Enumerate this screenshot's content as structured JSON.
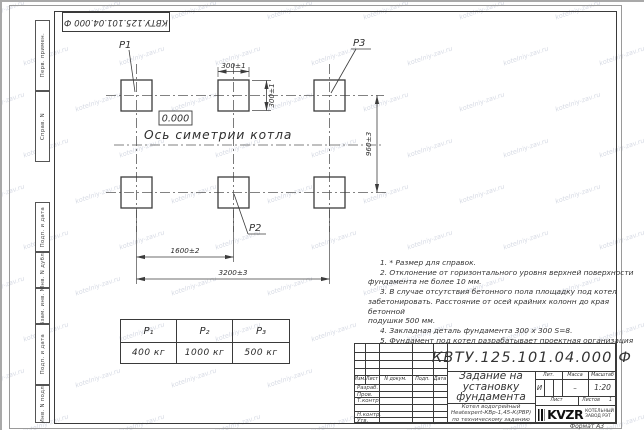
{
  "watermark": {
    "text": "kotelniy-zav.ru"
  },
  "stamp_top": {
    "designation": "КВТУ.125.101.04.000 Ф"
  },
  "frame": {
    "left_top_labels": [
      "Перв. примен.",
      "Справ. N"
    ],
    "left_bottom_labels": [
      "Подп. и дата",
      "Инв. N дубл.",
      "Взам. инв. N",
      "Подп. и дата",
      "Инв. N подл."
    ],
    "format_label": "Формат А3"
  },
  "drawing": {
    "pad_labels": {
      "p1": "P1",
      "p2": "P2",
      "p3": "P3"
    },
    "elevation": "0.000",
    "axis_label": "Ось симетрии котла",
    "dims": {
      "pad_width": "300±1",
      "pad_height": "300±1",
      "row_spacing": "960±3",
      "col_spacing": "1600±2",
      "total_width": "3200±3"
    }
  },
  "notes": {
    "lines": [
      "1. * Размер для справок.",
      "2. Отклонение от горизонтального уровня верхней поверхности",
      "фундамента не более 10 мм.",
      "3. В случае отсутствия бетонного пола площадку под котел",
      "забетонировать. Расстояние от осей крайних колонн до края бетонной",
      "подушки 500 мм.",
      "4. Закладная деталь фундамента 300 х 300 S=8.",
      "5. Фундамент под котел разрабатывает проектная организация",
      "по нагрузкам на фундамент."
    ]
  },
  "load_table": {
    "headers": [
      "P₁",
      "P₂",
      "P₃"
    ],
    "values": [
      "400 кг",
      "1000 кг",
      "500 кг"
    ]
  },
  "title_block": {
    "designation": "КВТУ.125.101.04.000  Ф",
    "doc_title_lines": [
      "Задание на",
      "установку",
      "фундамента"
    ],
    "subtitle_lines": [
      "Котел водогрейный",
      "Heatexpert-КВр-1,45-К(РВР)",
      "по техническому заданию"
    ],
    "header_cols": [
      "Изм.",
      "Лист",
      "N докум.",
      "Подп.",
      "Дата"
    ],
    "row_labels": [
      "Разраб.",
      "Пров.",
      "Т.контр.",
      "",
      "Н.контр.",
      "Утв."
    ],
    "lit_header": "Лит.",
    "mass_header": "Масса",
    "scale_header": "Масштаб",
    "lit_value": "И",
    "mass_value": "–",
    "scale_value": "1:20",
    "sheet_label": "Лист",
    "sheets_label": "Листов",
    "sheets_value": "1",
    "logo_text": "KVZR",
    "logo_sub_lines": [
      "КОТЕЛЬНЫЙ",
      "ЗАВОД РЭТ"
    ]
  }
}
